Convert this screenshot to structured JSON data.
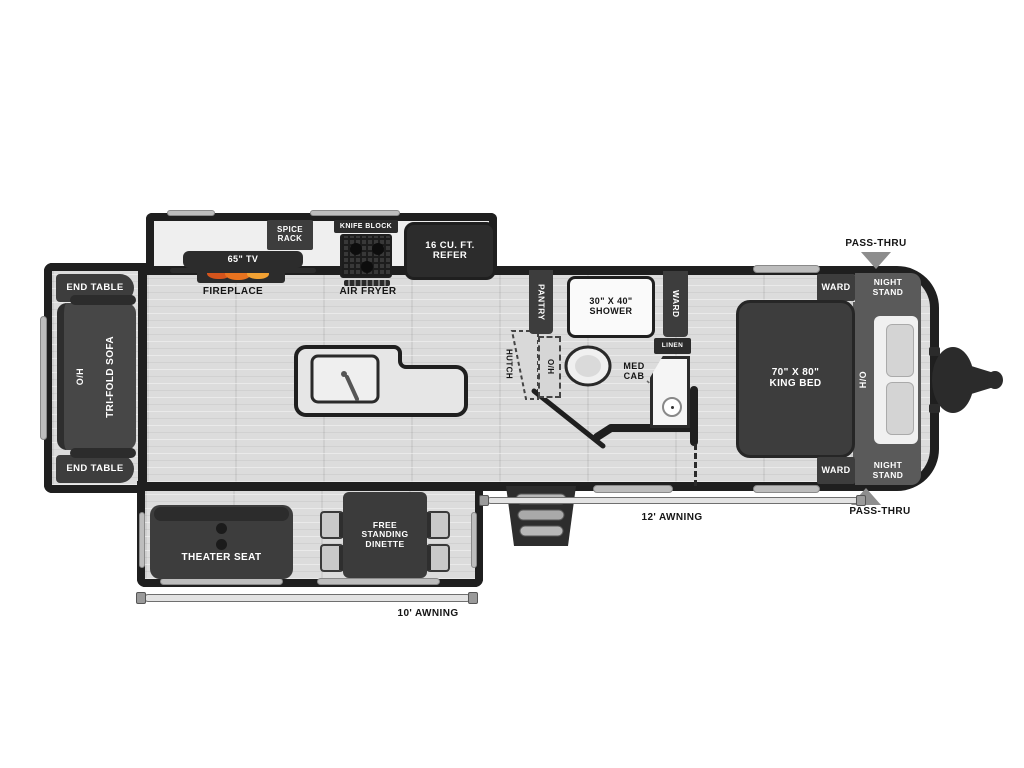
{
  "title": "Travel trailer floor plan",
  "colors": {
    "wall": "#1f1f1f",
    "furniture_dark": "#3d3d3d",
    "furniture_darker": "#2c2c2c",
    "floor": "#dcdcdc",
    "kitchen_counter": "#efefef",
    "night_stand_gray": "#5a5a5a",
    "flame_orange": "#e8731f",
    "arrow_gray": "#8d8d8d"
  },
  "rear": {
    "end_table_top": "END TABLE",
    "end_table_bottom": "END TABLE",
    "overhead": "O/H",
    "sofa": "TRI-FOLD SOFA"
  },
  "kitchen": {
    "tv": "65\" TV",
    "fireplace": "FIREPLACE",
    "spice_rack": "SPICE RACK",
    "knife_block": "KNIFE BLOCK",
    "air_fryer": "AIR FRYER",
    "refrigerator": "16 CU. FT. REFER"
  },
  "bath": {
    "pantry": "PANTRY",
    "hutch": "HUTCH",
    "overhead": "O/H",
    "shower": "30\" X 40\" SHOWER",
    "wardrobe": "WARD",
    "med_cab": "MED CAB",
    "linen": "LINEN"
  },
  "bedroom": {
    "bed": "70\" X 80\" KING BED",
    "hamper": "H/O",
    "ward_top": "WARD",
    "ward_bottom": "WARD",
    "night_stand_top": "NIGHT STAND",
    "night_stand_bottom": "NIGHT STAND",
    "pass_thru_top": "PASS-THRU",
    "pass_thru_bottom": "PASS-THRU"
  },
  "living": {
    "theater_seat": "THEATER SEAT",
    "dinette": "FREE STANDING DINETTE"
  },
  "exterior": {
    "awning_main": "12' AWNING",
    "awning_rear": "10' AWNING"
  }
}
